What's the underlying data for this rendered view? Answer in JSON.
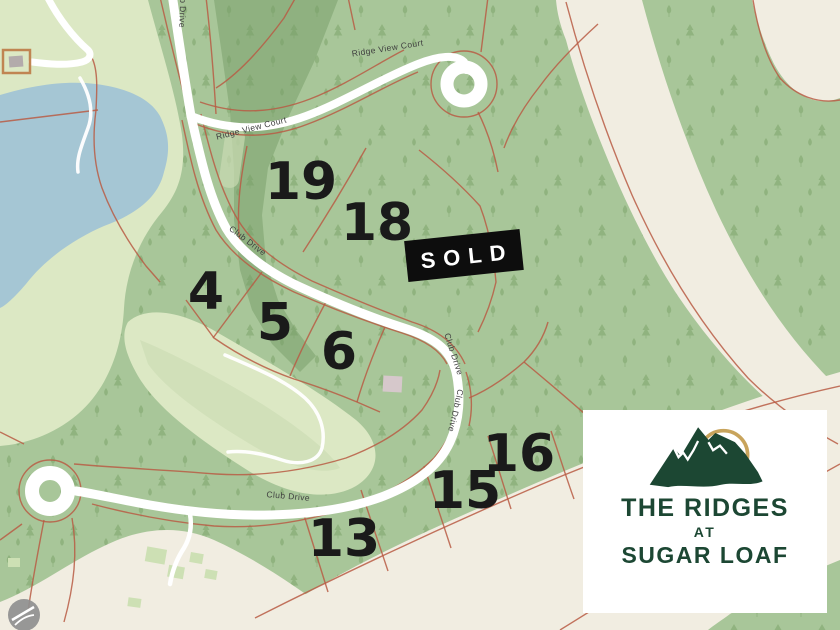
{
  "title": "The Ridges at Sugar Loaf lot map",
  "map": {
    "sold_badge": {
      "label": "SOLD"
    },
    "roads": {
      "club_drive": "Club Drive",
      "ridge_view_court": "Ridge View Court"
    },
    "lots": [
      {
        "number": "19"
      },
      {
        "number": "18"
      },
      {
        "number": "4"
      },
      {
        "number": "5"
      },
      {
        "number": "6"
      },
      {
        "number": "16"
      },
      {
        "number": "15"
      },
      {
        "number": "13"
      }
    ]
  },
  "logo_card": {
    "line1": "THE RIDGES",
    "line2": "AT",
    "line3": "SUGAR LOAF"
  },
  "colors": {
    "brand_green": "#1c4733",
    "logo_gold": "#c8a45c",
    "forest_green": "#a8c699",
    "dark_forest_green": "#8fb180",
    "open_green": "#dce8c4",
    "lake_blue": "#a5c6d4",
    "trail_beige": "#f1ede1",
    "parcel_line_red": "#b85c44",
    "road_white": "#ffffff",
    "sold_black": "#0d0d0d"
  }
}
